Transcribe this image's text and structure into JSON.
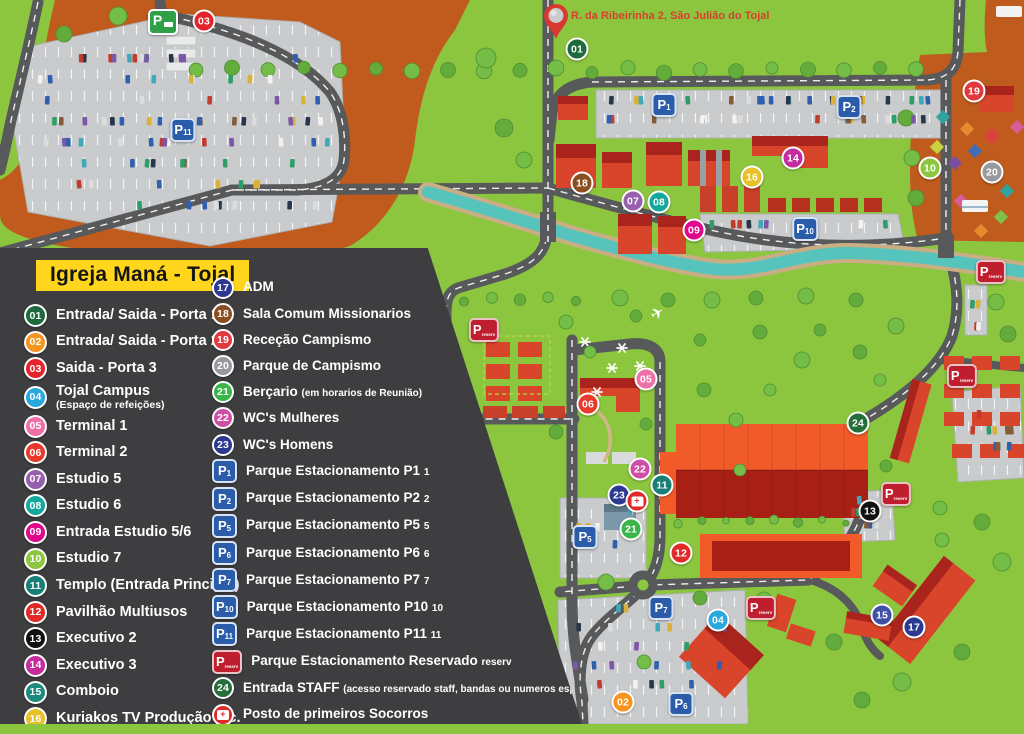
{
  "map": {
    "address": "R. da Ribeirinha 2, São Julião do Tojal"
  },
  "legend": {
    "title": "Igreja Maná - Tojal",
    "left": [
      {
        "id": "01",
        "color": "#1D6B3C",
        "label": "Entrada/ Saida - Porta 1"
      },
      {
        "id": "02",
        "color": "#F7941E",
        "label": "Entrada/ Saida - Porta 2"
      },
      {
        "id": "03",
        "color": "#E5232B",
        "label": "Saida - Porta 3"
      },
      {
        "id": "04",
        "color": "#29A8E0",
        "label": "Tojal Campus",
        "sub": "(Espaço de refeições)",
        "subBlock": true
      },
      {
        "id": "05",
        "color": "#EF6FA7",
        "label": "Terminal 1"
      },
      {
        "id": "06",
        "color": "#E8392C",
        "label": "Terminal 2"
      },
      {
        "id": "07",
        "color": "#9760AD",
        "label": "Estudio 5"
      },
      {
        "id": "08",
        "color": "#14A79D",
        "label": "Estudio 6"
      },
      {
        "id": "09",
        "color": "#E0078C",
        "label": "Entrada Estudio 5/6"
      },
      {
        "id": "10",
        "color": "#8CC63F",
        "label": "Estudio 7"
      },
      {
        "id": "11",
        "color": "#177F76",
        "label": "Templo (Entrada Principal)"
      },
      {
        "id": "12",
        "color": "#E02A28",
        "label": "Pavilhão Multiusos"
      },
      {
        "id": "13",
        "color": "#111111",
        "label": "Executivo 2"
      },
      {
        "id": "14",
        "color": "#C42B9E",
        "label": "Executivo 3"
      },
      {
        "id": "15",
        "color": "#1C8A7D",
        "label": "Comboio"
      },
      {
        "id": "16",
        "color": "#E8C127",
        "label": "Kuriakos TV Produção etc."
      }
    ],
    "right": [
      {
        "id": "17",
        "color": "#2B3990",
        "label": "ADM"
      },
      {
        "id": "18",
        "color": "#8A4E21",
        "label": "Sala Comum Missionarios"
      },
      {
        "id": "19",
        "color": "#E03A3E",
        "label": "Receção Campismo"
      },
      {
        "id": "20",
        "color": "#97999C",
        "label": "Parque de Campismo"
      },
      {
        "id": "21",
        "color": "#3AB54A",
        "label": "Berçario",
        "sub": "(em horarios de Reunião)"
      },
      {
        "id": "22",
        "color": "#CE4FA6",
        "label": "WC's Mulheres"
      },
      {
        "id": "23",
        "color": "#2B3990",
        "label": "WC's Homens"
      },
      {
        "id": "P1",
        "type": "parking",
        "sub": "1",
        "label": "Parque Estacionamento  P1"
      },
      {
        "id": "P2",
        "type": "parking",
        "sub": "2",
        "label": "Parque Estacionamento  P2"
      },
      {
        "id": "P5",
        "type": "parking",
        "sub": "5",
        "label": "Parque Estacionamento  P5"
      },
      {
        "id": "P6",
        "type": "parking",
        "sub": "6",
        "label": "Parque Estacionamento  P6"
      },
      {
        "id": "P7",
        "type": "parking",
        "sub": "7",
        "label": "Parque Estacionamento  P7"
      },
      {
        "id": "P10",
        "type": "parking",
        "sub": "10",
        "label": "Parque Estacionamento  P10"
      },
      {
        "id": "P11",
        "type": "parking",
        "sub": "11",
        "label": "Parque Estacionamento  P11"
      },
      {
        "id": "Pres",
        "type": "parking-reserved",
        "sub": "reserv",
        "label": "Parque Estacionamento Reservado"
      },
      {
        "id": "24",
        "color": "#256F3A",
        "label": "Entrada STAFF",
        "sub": "(acesso reservado staff, bandas ou numeros especiais)"
      },
      {
        "id": "aid",
        "type": "firstaid",
        "color": "#E02A28",
        "label": "Posto de primeiros Socorros"
      }
    ]
  },
  "markers": [
    {
      "id": "03",
      "x": 204,
      "y": 21,
      "color": "#E5232B"
    },
    {
      "id": "Pg",
      "x": 163,
      "y": 22,
      "type": "parking-green"
    },
    {
      "id": "01",
      "x": 577,
      "y": 49,
      "color": "#1D6B3C"
    },
    {
      "id": "P11",
      "x": 183,
      "y": 130,
      "type": "parking",
      "sub": "11"
    },
    {
      "id": "P1",
      "x": 664,
      "y": 105,
      "type": "parking",
      "sub": "1"
    },
    {
      "id": "P2",
      "x": 849,
      "y": 107,
      "type": "parking",
      "sub": "2"
    },
    {
      "id": "19",
      "x": 974,
      "y": 91,
      "color": "#E03A3E"
    },
    {
      "id": "14",
      "x": 793,
      "y": 158,
      "color": "#C42B9E"
    },
    {
      "id": "16",
      "x": 752,
      "y": 177,
      "color": "#E8C127"
    },
    {
      "id": "10",
      "x": 930,
      "y": 168,
      "color": "#8CC63F"
    },
    {
      "id": "20",
      "x": 992,
      "y": 172,
      "color": "#97999C"
    },
    {
      "id": "18",
      "x": 582,
      "y": 183,
      "color": "#8A4E21"
    },
    {
      "id": "07",
      "x": 633,
      "y": 201,
      "color": "#9760AD"
    },
    {
      "id": "08",
      "x": 659,
      "y": 202,
      "color": "#14A79D"
    },
    {
      "id": "09",
      "x": 694,
      "y": 230,
      "color": "#E0078C"
    },
    {
      "id": "P10",
      "x": 805,
      "y": 229,
      "type": "parking",
      "sub": "10"
    },
    {
      "id": "Pr1",
      "x": 991,
      "y": 272,
      "type": "parking-reserved",
      "sub": "reserv"
    },
    {
      "id": "Pr2",
      "x": 484,
      "y": 330,
      "type": "parking-reserved",
      "sub": "reserv"
    },
    {
      "id": "05",
      "x": 646,
      "y": 379,
      "color": "#EF6FA7"
    },
    {
      "id": "06",
      "x": 588,
      "y": 404,
      "color": "#E8392C"
    },
    {
      "id": "Pr3",
      "x": 962,
      "y": 376,
      "type": "parking-reserved",
      "sub": "reserv"
    },
    {
      "id": "24",
      "x": 858,
      "y": 423,
      "color": "#256F3A"
    },
    {
      "id": "22",
      "x": 640,
      "y": 469,
      "color": "#CE4FA6"
    },
    {
      "id": "11",
      "x": 662,
      "y": 485,
      "color": "#177F76"
    },
    {
      "id": "23",
      "x": 619,
      "y": 495,
      "color": "#2B3990"
    },
    {
      "id": "aid1",
      "x": 637,
      "y": 501,
      "type": "firstaid"
    },
    {
      "id": "Pr4",
      "x": 896,
      "y": 494,
      "type": "parking-reserved",
      "sub": "reserv"
    },
    {
      "id": "13",
      "x": 870,
      "y": 511,
      "color": "#111111"
    },
    {
      "id": "21",
      "x": 631,
      "y": 529,
      "color": "#3AB54A"
    },
    {
      "id": "P5",
      "x": 585,
      "y": 537,
      "type": "parking",
      "sub": "5"
    },
    {
      "id": "12",
      "x": 681,
      "y": 553,
      "color": "#E02A28"
    },
    {
      "id": "Pr5",
      "x": 761,
      "y": 608,
      "type": "parking-reserved",
      "sub": "reserv"
    },
    {
      "id": "P7",
      "x": 661,
      "y": 608,
      "type": "parking",
      "sub": "7"
    },
    {
      "id": "15",
      "x": 882,
      "y": 615,
      "color": "#3F51A5"
    },
    {
      "id": "04",
      "x": 718,
      "y": 620,
      "color": "#29A8E0"
    },
    {
      "id": "17",
      "x": 914,
      "y": 627,
      "color": "#2B3990"
    },
    {
      "id": "02",
      "x": 623,
      "y": 702,
      "color": "#F7941E"
    },
    {
      "id": "P6",
      "x": 681,
      "y": 704,
      "type": "parking",
      "sub": "6"
    }
  ],
  "colors": {
    "grass": "#8CC63F",
    "dirt": "#C05A1D",
    "road": "#58595B",
    "river": "#56C3BD",
    "river_bank": "#C9AE84",
    "panel": "#3E3E40",
    "title_bg": "#FFD51E",
    "parking_sign": "#2A5CAA",
    "reserved_sign": "#BE1E2D",
    "building": "#D8452A",
    "building_roof": "#A8241C",
    "address_text": "#D6402F",
    "legend_text": "#FFFFFF"
  }
}
